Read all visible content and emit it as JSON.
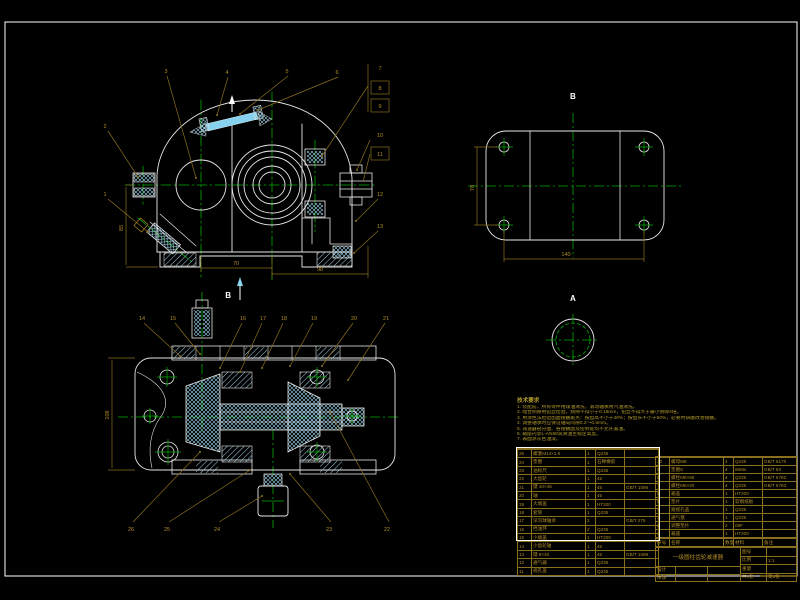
{
  "colors": {
    "background": "#000000",
    "outline": "#e8e8e8",
    "centerline": "#00aa00",
    "dimension": "#b08c28",
    "table_line": "#8a701e",
    "hatch": "#9fd2e8",
    "highlight_bolt": "#86d2ee"
  },
  "labels": {
    "plate_view": "B",
    "a_view": "A",
    "section_arrow": "B"
  },
  "dims": {
    "front_width": "70",
    "front_total": "98",
    "front_height": "85",
    "plate_length": "140",
    "plate_width": "78",
    "section_height": "108"
  },
  "callouts": {
    "front": [
      "1",
      "2",
      "3",
      "4",
      "5",
      "6",
      "7",
      "8",
      "9",
      "10",
      "11",
      "12",
      "13"
    ],
    "section": [
      "14",
      "15",
      "16",
      "17",
      "18",
      "19",
      "20",
      "21",
      "22",
      "23",
      "24",
      "25",
      "26"
    ]
  },
  "notes": {
    "title": "技术要求",
    "lines": [
      "1. 装配前，所有零件用煤油清洗，滚动轴承用汽油清洗。",
      "2. 啮合侧隙用铅丝检验，侧隙不得小于0.16mm，铅丝不得大于最小侧隙4倍。",
      "3. 用涂色法检验齿面接触斑点：按齿高不小于40%；按齿长不小于50%，必要时研磨改善接触。",
      "4. 调整轴承时应保证轴向间隙0.2～0.5mm。",
      "5. 减速器剖分面、各接触面及密封处均不允许漏油。",
      "6. 箱座内装L-AN68润滑油至规定高度。",
      "7. 表面涂灰色油漆。"
    ]
  },
  "bom": {
    "headers": [
      "序号",
      "名称",
      "数量",
      "材料",
      "备注"
    ],
    "left_rows": [
      {
        "no": "25",
        "name": "螺塞M14×1.5",
        "qty": "1",
        "material": "Q235",
        "remark": ""
      },
      {
        "no": "24",
        "name": "垫圈",
        "qty": "1",
        "material": "石棉橡胶",
        "remark": ""
      },
      {
        "no": "23",
        "name": "油标尺",
        "qty": "1",
        "material": "Q235",
        "remark": ""
      },
      {
        "no": "22",
        "name": "大齿轮",
        "qty": "1",
        "material": "45",
        "remark": ""
      },
      {
        "no": "21",
        "name": "键 10×45",
        "qty": "1",
        "material": "45",
        "remark": "GB/T 1096"
      },
      {
        "no": "20",
        "name": "轴",
        "qty": "1",
        "material": "45",
        "remark": ""
      },
      {
        "no": "19",
        "name": "大端盖",
        "qty": "1",
        "material": "HT200",
        "remark": ""
      },
      {
        "no": "18",
        "name": "套筒",
        "qty": "1",
        "material": "Q235",
        "remark": ""
      },
      {
        "no": "17",
        "name": "深沟球轴承",
        "qty": "2",
        "material": "",
        "remark": "GB/T 276"
      },
      {
        "no": "16",
        "name": "挡油环",
        "qty": "2",
        "material": "Q235",
        "remark": ""
      },
      {
        "no": "15",
        "name": "小端盖",
        "qty": "1",
        "material": "HT200",
        "remark": ""
      },
      {
        "no": "14",
        "name": "小齿轮轴",
        "qty": "1",
        "material": "45",
        "remark": ""
      },
      {
        "no": "13",
        "name": "键 8×40",
        "qty": "1",
        "material": "45",
        "remark": "GB/T 1096"
      },
      {
        "no": "12",
        "name": "通气器",
        "qty": "1",
        "material": "Q235",
        "remark": ""
      },
      {
        "no": "11",
        "name": "视孔盖",
        "qty": "1",
        "material": "Q235",
        "remark": ""
      }
    ],
    "right_rows": [
      {
        "no": "10",
        "name": "螺母M8",
        "qty": "4",
        "material": "Q235",
        "remark": "GB/T 6170"
      },
      {
        "no": "9",
        "name": "垫圈8",
        "qty": "4",
        "material": "65Mn",
        "remark": "GB/T 93"
      },
      {
        "no": "8",
        "name": "螺栓M8×65",
        "qty": "4",
        "material": "Q235",
        "remark": "GB/T 5782"
      },
      {
        "no": "7",
        "name": "螺栓M6×20",
        "qty": "4",
        "material": "Q235",
        "remark": "GB/T 5783"
      },
      {
        "no": "6",
        "name": "箱盖",
        "qty": "1",
        "material": "HT200",
        "remark": ""
      },
      {
        "no": "5",
        "name": "垫片",
        "qty": "1",
        "material": "软钢纸板",
        "remark": ""
      },
      {
        "no": "4",
        "name": "窥视孔盖",
        "qty": "1",
        "material": "Q235",
        "remark": ""
      },
      {
        "no": "3",
        "name": "通气塞",
        "qty": "1",
        "material": "Q235",
        "remark": ""
      },
      {
        "no": "2",
        "name": "调整垫片",
        "qty": "2",
        "material": "08F",
        "remark": ""
      },
      {
        "no": "1",
        "name": "箱座",
        "qty": "1",
        "material": "HT200",
        "remark": ""
      }
    ]
  },
  "title_block": {
    "title": "一级圆柱齿轮减速器",
    "fields": [
      {
        "label": "图号",
        "value": ""
      },
      {
        "label": "比例",
        "value": "1:1"
      },
      {
        "label": "重量",
        "value": ""
      },
      {
        "label": "共1张",
        "value": "第1张"
      }
    ],
    "signs": [
      {
        "label": "设计",
        "c1": "",
        "c2": ""
      },
      {
        "label": "审核",
        "c1": "",
        "c2": ""
      }
    ]
  }
}
